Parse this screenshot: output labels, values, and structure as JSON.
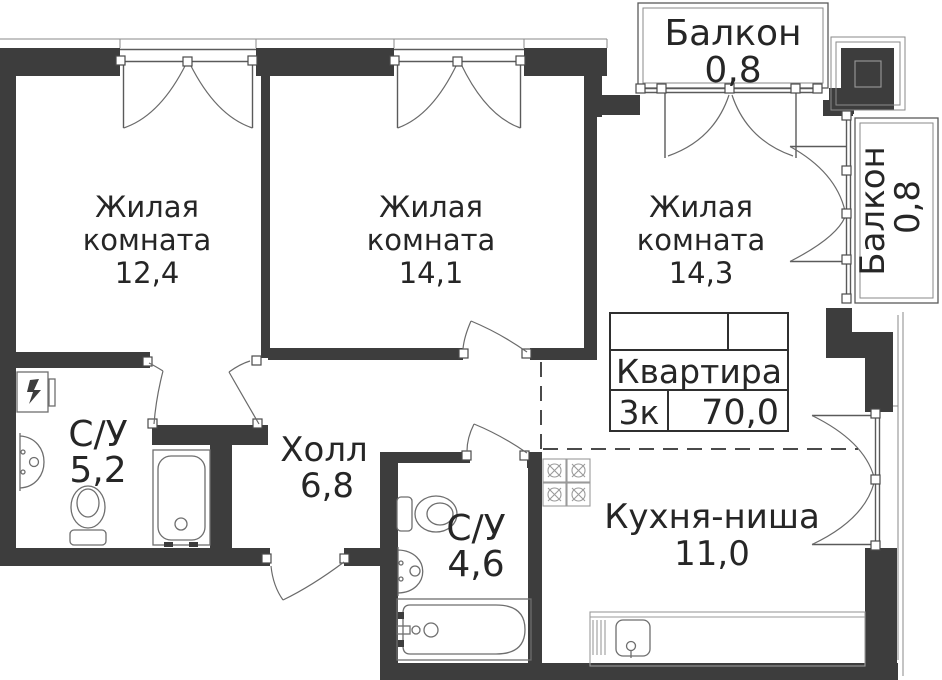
{
  "plan": {
    "title": "Floor plan of 3-room apartment",
    "rooms": [
      {
        "name_lines": [
          "Жилая",
          "комната"
        ],
        "area": "12,4"
      },
      {
        "name_lines": [
          "Жилая",
          "комната"
        ],
        "area": "14,1"
      },
      {
        "name_lines": [
          "Жилая",
          "комната"
        ],
        "area": "14,3"
      },
      {
        "name_lines": [
          "Холл"
        ],
        "area": "6,8"
      },
      {
        "name_lines": [
          "С/У"
        ],
        "area": "5,2"
      },
      {
        "name_lines": [
          "С/У"
        ],
        "area": "4,6"
      },
      {
        "name_lines": [
          "Кухня-ниша"
        ],
        "area": "11,0"
      },
      {
        "name_lines": [
          "Балкон"
        ],
        "area": "0,8"
      },
      {
        "name_lines": [
          "Балкон"
        ],
        "area": "0,8"
      }
    ],
    "apartment_card": {
      "title": "Квартира",
      "rooms_short": "3к",
      "total_area": "70,0"
    },
    "icons": [
      "electrical-panel-icon",
      "sink-icon",
      "toilet-icon",
      "bathtub-icon",
      "stove-icon",
      "kitchen-sink-icon"
    ],
    "colors": {
      "wall": "#3d3d3d",
      "line": "#5a5a5a",
      "fixture": "#6e6e6e",
      "text": "#262626",
      "background": "#ffffff"
    }
  }
}
